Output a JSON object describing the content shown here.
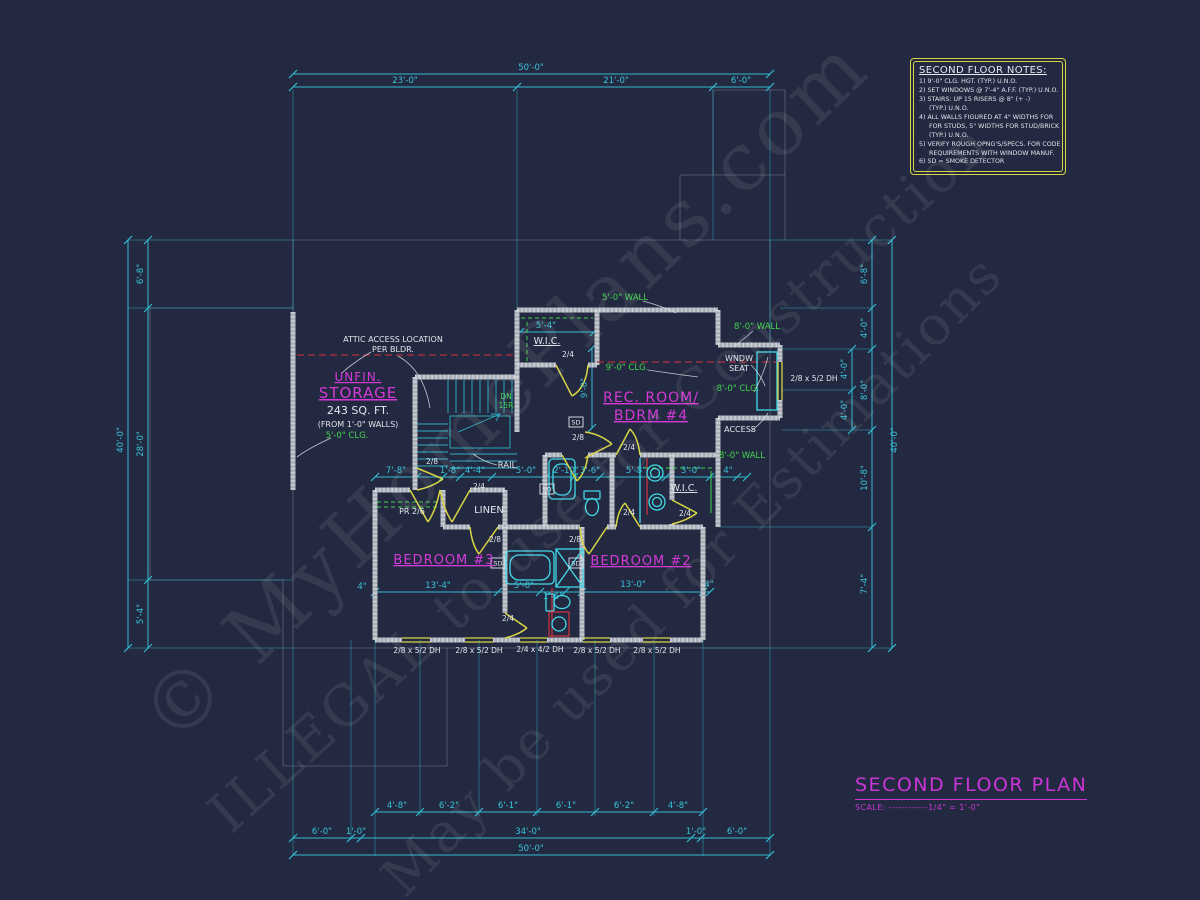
{
  "colors": {
    "background": "#232940",
    "cyan": "#33bcd1",
    "magenta": "#cb35d6",
    "green": "#42d44e",
    "yellow": "#d8d545",
    "red": "#cf3540",
    "wall_gray": "#a9afb8",
    "white": "#e2e6ec"
  },
  "watermarks": {
    "w1": "© MyHomePlans.com",
    "w2": "ILLEGAL to use for Construction",
    "w3": "May be used for Estimations"
  },
  "notes": {
    "title": "SECOND FLOOR NOTES:",
    "lines": [
      "1) 9'-0\" CLG. HGT. (TYP.) U.N.O.",
      "2) SET WINDOWS @ 7'-4\" A.F.F. (TYP.) U.N.O.",
      "3) STAIRS: UP 15 RISERS @ 8\" (+ -)",
      "     (TYP.) U.N.O.",
      "4) ALL WALLS FIGURED AT 4\" WIDTHS FOR",
      "     FOR STUDS, 5\" WIDTHS FOR STUD/BRICK",
      "     (TYP.) U.N.O.",
      "5) VERIFY ROUGH OPNG'S/SPECS. FOR CODE",
      "     REQUIREMENTS WITH WINDOW MANUF.",
      "6) SD = SMOKE DETECTOR"
    ]
  },
  "titleblock": {
    "title": "SECOND FLOOR PLAN",
    "scale": "SCALE: ------------1/4\" = 1'-0\""
  },
  "plan": {
    "sd_label": "SD",
    "labels": [
      {
        "t": "50'-0\"",
        "x": 531,
        "y": 70,
        "c": "c"
      },
      {
        "t": "23'-0\"",
        "x": 405,
        "y": 83,
        "c": "c"
      },
      {
        "t": "21'-0\"",
        "x": 616,
        "y": 83,
        "c": "c"
      },
      {
        "t": "6'-0\"",
        "x": 741,
        "y": 83,
        "c": "c"
      },
      {
        "t": "4'-8\"",
        "x": 397,
        "y": 808,
        "c": "c"
      },
      {
        "t": "6'-2\"",
        "x": 449,
        "y": 808,
        "c": "c"
      },
      {
        "t": "6'-1\"",
        "x": 508,
        "y": 808,
        "c": "c"
      },
      {
        "t": "6'-1\"",
        "x": 566,
        "y": 808,
        "c": "c"
      },
      {
        "t": "6'-2\"",
        "x": 624,
        "y": 808,
        "c": "c"
      },
      {
        "t": "4'-8\"",
        "x": 678,
        "y": 808,
        "c": "c"
      },
      {
        "t": "6'-0\"",
        "x": 322,
        "y": 834,
        "c": "c"
      },
      {
        "t": "1'-0\"",
        "x": 356,
        "y": 834,
        "c": "c"
      },
      {
        "t": "34'-0\"",
        "x": 528,
        "y": 834,
        "c": "c"
      },
      {
        "t": "1'-0\"",
        "x": 696,
        "y": 834,
        "c": "c"
      },
      {
        "t": "6'-0\"",
        "x": 737,
        "y": 834,
        "c": "c"
      },
      {
        "t": "50'-0\"",
        "x": 531,
        "y": 851,
        "c": "c"
      },
      {
        "t": "40'-0\"",
        "x": 123,
        "y": 440,
        "c": "c",
        "r": -90
      },
      {
        "t": "6'-8\"",
        "x": 143,
        "y": 274,
        "c": "c",
        "r": -90
      },
      {
        "t": "28'-0\"",
        "x": 143,
        "y": 444,
        "c": "c",
        "r": -90
      },
      {
        "t": "5'-4\"",
        "x": 143,
        "y": 614,
        "c": "c",
        "r": -90
      },
      {
        "t": "6'-8\"",
        "x": 867,
        "y": 274,
        "c": "c",
        "r": -90
      },
      {
        "t": "4'-0\"",
        "x": 867,
        "y": 328,
        "c": "c",
        "r": -90
      },
      {
        "t": "4'-0\"",
        "x": 847,
        "y": 369,
        "c": "c",
        "r": -90
      },
      {
        "t": "4'-0\"",
        "x": 847,
        "y": 410,
        "c": "c",
        "r": -90
      },
      {
        "t": "8'-0\"",
        "x": 867,
        "y": 390,
        "c": "c",
        "r": -90
      },
      {
        "t": "40'-0\"",
        "x": 897,
        "y": 440,
        "c": "c",
        "r": -90
      },
      {
        "t": "10'-8\"",
        "x": 867,
        "y": 478,
        "c": "c",
        "r": -90
      },
      {
        "t": "7'-4\"",
        "x": 867,
        "y": 584,
        "c": "c",
        "r": -90
      },
      {
        "t": "7'-8\"",
        "x": 396,
        "y": 473,
        "c": "c"
      },
      {
        "t": "1'-8\"",
        "x": 450,
        "y": 473,
        "c": "c"
      },
      {
        "t": "4'-4\"",
        "x": 475,
        "y": 473,
        "c": "c"
      },
      {
        "t": "5'-0\"",
        "x": 526,
        "y": 473,
        "c": "c"
      },
      {
        "t": "2'-10\"",
        "x": 566,
        "y": 473,
        "c": "c"
      },
      {
        "t": "3'-6\"",
        "x": 590,
        "y": 473,
        "c": "c"
      },
      {
        "t": "5'-8\"",
        "x": 636,
        "y": 473,
        "c": "c"
      },
      {
        "t": "3'-0\"",
        "x": 691,
        "y": 473,
        "c": "c"
      },
      {
        "t": "4\"",
        "x": 728,
        "y": 473,
        "c": "c"
      },
      {
        "t": "13'-4\"",
        "x": 438,
        "y": 588,
        "c": "c"
      },
      {
        "t": "5'-0\"",
        "x": 524,
        "y": 588,
        "c": "c"
      },
      {
        "t": "1'-6\"",
        "x": 553,
        "y": 599,
        "c": "c"
      },
      {
        "t": "13'-0\"",
        "x": 633,
        "y": 587,
        "c": "c"
      },
      {
        "t": "4\"",
        "x": 709,
        "y": 587,
        "c": "c"
      },
      {
        "t": "4\"",
        "x": 362,
        "y": 589,
        "c": "c"
      },
      {
        "t": "5'-4\"",
        "x": 546,
        "y": 328,
        "c": "c"
      },
      {
        "t": "9'-0\"",
        "x": 587,
        "y": 388,
        "c": "c",
        "r": -90
      },
      {
        "t": "2/8 x 5/2 DH",
        "x": 814,
        "y": 381,
        "c": "w",
        "s": 7.5
      },
      {
        "t": "2/8 x 5/2 DH",
        "x": 417,
        "y": 653,
        "c": "w",
        "s": 7.5
      },
      {
        "t": "2/8 x 5/2 DH",
        "x": 479,
        "y": 653,
        "c": "w",
        "s": 7.5
      },
      {
        "t": "2/4 x 4/2 DH",
        "x": 540,
        "y": 652,
        "c": "w",
        "s": 7.5
      },
      {
        "t": "2/8 x 5/2 DH",
        "x": 597,
        "y": 653,
        "c": "w",
        "s": 7.5
      },
      {
        "t": "2/8 x 5/2 DH",
        "x": 657,
        "y": 653,
        "c": "w",
        "s": 7.5
      },
      {
        "t": "UNFIN.",
        "x": 358,
        "y": 381,
        "c": "m",
        "s": 12,
        "u": 1
      },
      {
        "t": "STORAGE",
        "x": 358,
        "y": 398,
        "c": "m",
        "s": 15,
        "u": 1
      },
      {
        "t": "243 SQ. FT.",
        "x": 358,
        "y": 414,
        "c": "w",
        "s": 11
      },
      {
        "t": "(FROM 1'-0\" WALLS)",
        "x": 358,
        "y": 427,
        "c": "w",
        "s": 8
      },
      {
        "t": "REC. ROOM/",
        "x": 651,
        "y": 402,
        "c": "m",
        "s": 14,
        "u": 1
      },
      {
        "t": "BDRM #4",
        "x": 651,
        "y": 420,
        "c": "m",
        "s": 14,
        "u": 1
      },
      {
        "t": "BEDROOM #3",
        "x": 444,
        "y": 564,
        "c": "m",
        "s": 13,
        "u": 1
      },
      {
        "t": "BEDROOM #2",
        "x": 641,
        "y": 565,
        "c": "m",
        "s": 13,
        "u": 1
      },
      {
        "t": "5'-0\" CLG.",
        "x": 347,
        "y": 438,
        "c": "g"
      },
      {
        "t": "5'-0\" WALL",
        "x": 625,
        "y": 300,
        "c": "g"
      },
      {
        "t": "8'-0\" WALL",
        "x": 757,
        "y": 329,
        "c": "g"
      },
      {
        "t": "9'-0\" CLG.",
        "x": 627,
        "y": 370,
        "c": "g"
      },
      {
        "t": "8'-0\" CLG.",
        "x": 738,
        "y": 391,
        "c": "g"
      },
      {
        "t": "8'-0\" WALL",
        "x": 742,
        "y": 458,
        "c": "g"
      },
      {
        "t": "DN",
        "x": 506,
        "y": 399,
        "c": "g",
        "s": 7.5
      },
      {
        "t": "15R",
        "x": 506,
        "y": 408,
        "c": "g",
        "s": 7.5
      },
      {
        "t": "ATTIC ACCESS LOCATION",
        "x": 393,
        "y": 342,
        "c": "w",
        "s": 8
      },
      {
        "t": "PER BLDR.",
        "x": 393,
        "y": 352,
        "c": "w",
        "s": 8
      },
      {
        "t": "W.I.C.",
        "x": 547,
        "y": 344,
        "c": "w",
        "s": 9.5,
        "u": 1
      },
      {
        "t": "W.I.C.",
        "x": 684,
        "y": 491,
        "c": "w",
        "s": 9.5,
        "u": 1
      },
      {
        "t": "LINEN",
        "x": 489,
        "y": 513,
        "c": "w",
        "s": 10
      },
      {
        "t": "PR 2/6",
        "x": 412,
        "y": 514,
        "c": "w",
        "s": 8
      },
      {
        "t": "RAIL",
        "x": 507,
        "y": 468,
        "c": "w",
        "s": 8.5
      },
      {
        "t": "WNDW",
        "x": 739,
        "y": 361,
        "c": "w",
        "s": 8
      },
      {
        "t": "SEAT",
        "x": 739,
        "y": 371,
        "c": "w",
        "s": 8
      },
      {
        "t": "ACCESS",
        "x": 740,
        "y": 432,
        "c": "w",
        "s": 8
      },
      {
        "t": "2/4",
        "x": 568,
        "y": 357,
        "c": "w",
        "s": 7.5
      },
      {
        "t": "2/8",
        "x": 578,
        "y": 440,
        "c": "w",
        "s": 7.5
      },
      {
        "t": "2/8",
        "x": 432,
        "y": 464,
        "c": "w",
        "s": 7.5
      },
      {
        "t": "2/4",
        "x": 479,
        "y": 489,
        "c": "w",
        "s": 7.5
      },
      {
        "t": "2/8",
        "x": 495,
        "y": 542,
        "c": "w",
        "s": 7.5
      },
      {
        "t": "2/8",
        "x": 575,
        "y": 542,
        "c": "w",
        "s": 7.5
      },
      {
        "t": "2/4",
        "x": 629,
        "y": 450,
        "c": "w",
        "s": 7.5
      },
      {
        "t": "2/4",
        "x": 629,
        "y": 515,
        "c": "w",
        "s": 7.5
      },
      {
        "t": "2/4",
        "x": 685,
        "y": 516,
        "c": "w",
        "s": 7.5
      },
      {
        "t": "2/4",
        "x": 508,
        "y": 621,
        "c": "w",
        "s": 7.5
      }
    ]
  }
}
